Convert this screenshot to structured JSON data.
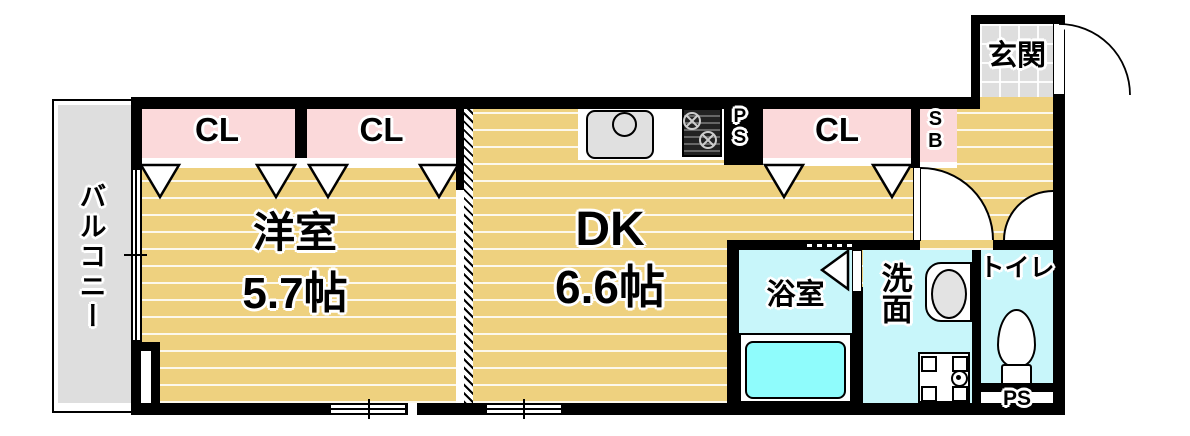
{
  "floorplan": {
    "balcony": {
      "label": "バルコニー"
    },
    "western_room": {
      "name": "洋室",
      "size": "5.7帖"
    },
    "dining_kitchen": {
      "name": "DK",
      "size": "6.6帖"
    },
    "entrance": {
      "label": "玄関"
    },
    "bathroom": {
      "label": "浴室"
    },
    "washroom": {
      "label": "洗面"
    },
    "toilet": {
      "label": "トイレ"
    },
    "closet_west_1": {
      "label": "CL"
    },
    "closet_west_2": {
      "label": "CL"
    },
    "closet_dk": {
      "label": "CL"
    },
    "shoe_box": {
      "label": "SB"
    },
    "pipe_space_kitchen": {
      "label": "PS"
    },
    "pipe_space_toilet": {
      "label": "PS"
    },
    "colors": {
      "floor_wood": "#eed17f",
      "closet_pink": "#fbd9da",
      "wet_area_cyan": "#c8f6fa",
      "bathtub_cyan": "#8ffcfc",
      "tile_gray": "#dedede",
      "wall_black": "#000000"
    }
  }
}
